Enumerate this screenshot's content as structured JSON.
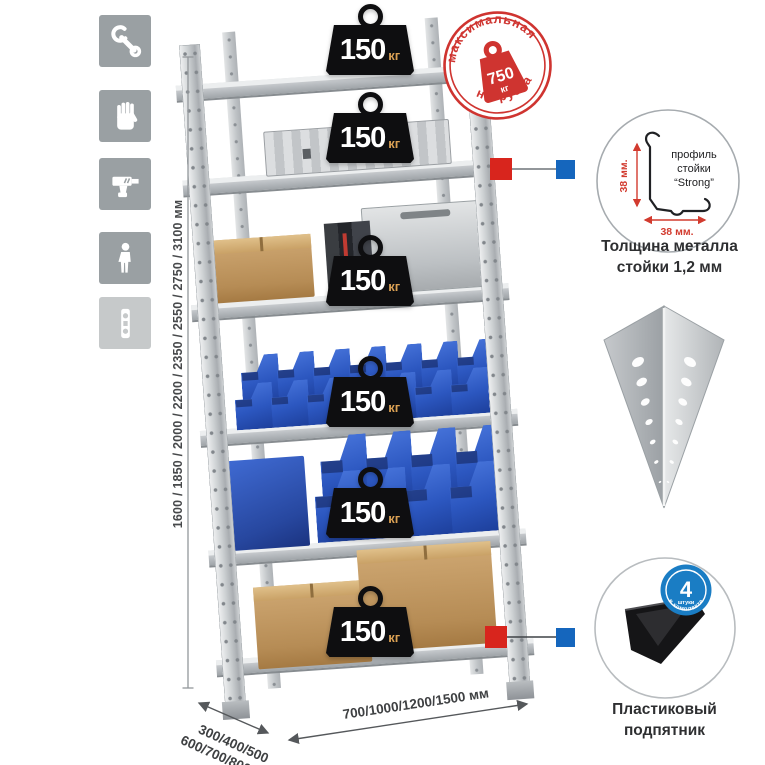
{
  "sidebar_icons": [
    {
      "name": "wrench"
    },
    {
      "name": "gloves"
    },
    {
      "name": "drill"
    },
    {
      "name": "person"
    },
    {
      "name": "level"
    }
  ],
  "rack": {
    "shelf_badges": [
      {
        "value": "150",
        "unit": "кг"
      },
      {
        "value": "150",
        "unit": "кг"
      },
      {
        "value": "150",
        "unit": "кг"
      },
      {
        "value": "150",
        "unit": "кг"
      },
      {
        "value": "150",
        "unit": "кг"
      },
      {
        "value": "150",
        "unit": "кг"
      }
    ]
  },
  "stamp": {
    "arc_top": "максимальная",
    "arc_bottom": "нагрузка",
    "weight_value": "750",
    "weight_unit": "кг"
  },
  "dimensions": {
    "height_options": "1600 / 1850 / 2000 / 2200 / 2350 / 2550 / 2750 / 3100 мм",
    "depth_options_line1": "300/400/500",
    "depth_options_line2": "600/700/800 мм",
    "width_options": "700/1000/1200/1500 мм"
  },
  "details": {
    "profile": {
      "dim_vertical": "38 мм.",
      "dim_horizontal": "38 мм.",
      "label_lines": [
        "профиль",
        "стойки",
        "“Strong”"
      ],
      "caption_line1": "Толщина металла",
      "caption_line2": "стойки 1,2 мм"
    },
    "foot": {
      "badge_value": "4",
      "badge_sub": "штуки",
      "badge_arc": "в комплекте",
      "caption_line1": "Пластиковый",
      "caption_line2": "подпятник"
    }
  },
  "colors": {
    "stamp_red": "#cf3430",
    "badge_black": "#0e0e10",
    "bin_blue": "#2c57c0",
    "marker_red": "#d8251d",
    "marker_blue": "#1566bd",
    "kit_badge_blue": "#1a7dc4"
  }
}
